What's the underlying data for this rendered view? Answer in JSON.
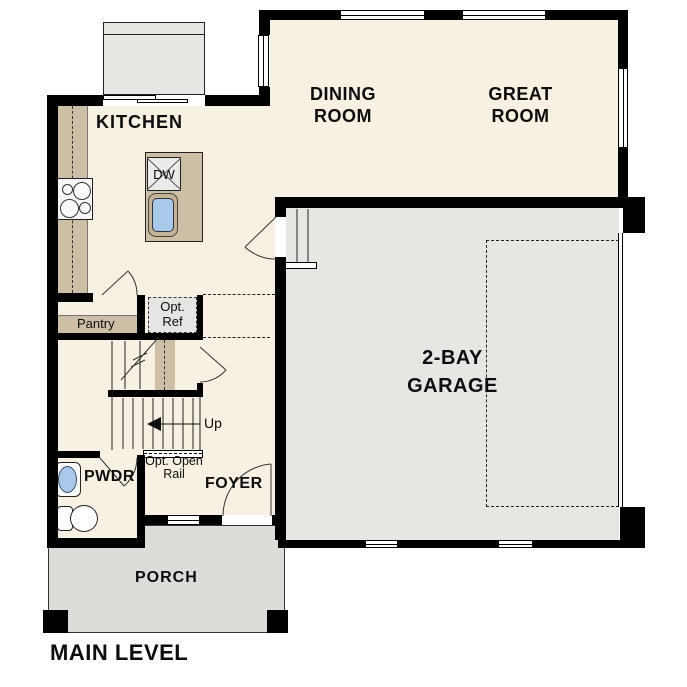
{
  "title": "MAIN LEVEL",
  "rooms": {
    "kitchen": "KITCHEN",
    "dining": "DINING\nROOM",
    "great": "GREAT\nROOM",
    "garage": "2-BAY\nGARAGE",
    "pwdr": "PWDR",
    "foyer": "FOYER",
    "porch": "PORCH",
    "pantry": "Pantry"
  },
  "labels": {
    "dw": "DW",
    "opt_ref": "Opt.\nRef",
    "up": "Up",
    "opt_open_rail": "Opt. Open\nRail"
  },
  "colors": {
    "floor": "#f8f0e3",
    "garage_floor": "#e6e6e3",
    "porch_floor": "#dcdcd9",
    "counter_tan": "#ccbfa6",
    "sink_blue": "#a9c9ea",
    "wall": "#000000"
  }
}
